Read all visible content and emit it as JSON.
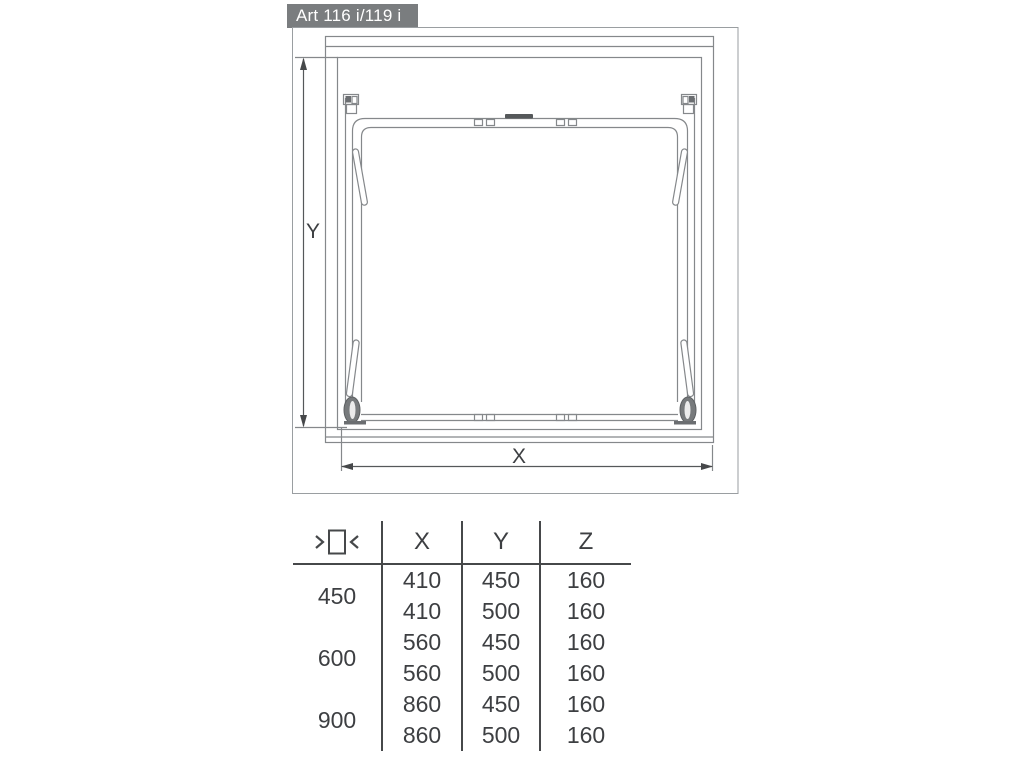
{
  "title": "Art 116 i/119 i",
  "diagram": {
    "dim_x_label": "X",
    "dim_y_label": "Y"
  },
  "table": {
    "width_icon": "inner-cabinet-width-icon",
    "columns": [
      "X",
      "Y",
      "Z"
    ],
    "groups": [
      {
        "width": "450",
        "rows": [
          [
            "410",
            "450",
            "160"
          ],
          [
            "410",
            "500",
            "160"
          ]
        ]
      },
      {
        "width": "600",
        "rows": [
          [
            "560",
            "450",
            "160"
          ],
          [
            "560",
            "500",
            "160"
          ]
        ]
      },
      {
        "width": "900",
        "rows": [
          [
            "860",
            "450",
            "160"
          ],
          [
            "860",
            "500",
            "160"
          ]
        ]
      }
    ]
  },
  "colors": {
    "title_bg": "#7a7d7f",
    "title_text": "#ffffff",
    "drawing_line": "#85888b",
    "dimension_line": "#55585a",
    "table_line": "#46484a",
    "text": "#3d3f42"
  }
}
